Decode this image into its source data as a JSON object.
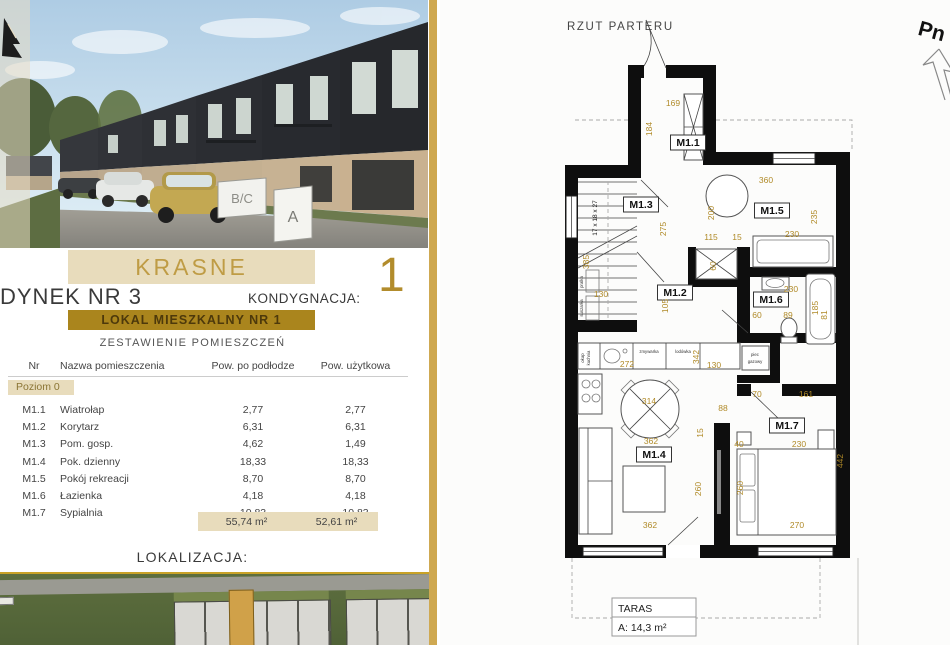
{
  "left": {
    "project_title": "KRASNE",
    "building_title": "DYNEK NR 3",
    "kondygnacja_label": "KONDYGNACJA:",
    "kondygnacja_value": "1",
    "lokal_band": "LOKAL MIESZKALNY NR 1",
    "table_title": "ZESTAWIENIE POMIESZCZEŃ",
    "lokalizacja_label": "LOKALIZACJA:",
    "table": {
      "headers": [
        "Nr",
        "Nazwa pomieszczenia",
        "Pow. po podłodze",
        "Pow. użytkowa"
      ],
      "level_label": "Poziom 0",
      "rows": [
        {
          "nr": "M1.1",
          "name": "Wiatrołap",
          "floor": "2,77",
          "usable": "2,77"
        },
        {
          "nr": "M1.2",
          "name": "Korytarz",
          "floor": "6,31",
          "usable": "6,31"
        },
        {
          "nr": "M1.3",
          "name": "Pom. gosp.",
          "floor": "4,62",
          "usable": "1,49"
        },
        {
          "nr": "M1.4",
          "name": "Pok. dzienny",
          "floor": "18,33",
          "usable": "18,33"
        },
        {
          "nr": "M1.5",
          "name": "Pokój rekreacji",
          "floor": "8,70",
          "usable": "8,70"
        },
        {
          "nr": "M1.6",
          "name": "Łazienka",
          "floor": "4,18",
          "usable": "4,18"
        },
        {
          "nr": "M1.7",
          "name": "Sypialnia",
          "floor": "10,83",
          "usable": "10,83"
        }
      ],
      "total_floor": "55,74 m²",
      "total_usable": "52,61 m²"
    }
  },
  "photo": {
    "signs": [
      "B/C",
      "A"
    ]
  },
  "plan": {
    "title": "RZUT PARTERU",
    "terrace": {
      "name": "TARAS",
      "area": "A: 14,3 m²"
    },
    "labels": [
      {
        "t": "M1.1",
        "x": 688,
        "y": 146,
        "cls": "room",
        "box": [
          35,
          15
        ]
      },
      {
        "t": "M1.2",
        "x": 675,
        "y": 296,
        "cls": "room",
        "box": [
          35,
          15
        ]
      },
      {
        "t": "M1.3",
        "x": 641,
        "y": 208,
        "cls": "room",
        "box": [
          35,
          15
        ]
      },
      {
        "t": "M1.4",
        "x": 654,
        "y": 458,
        "cls": "room",
        "box": [
          35,
          15
        ]
      },
      {
        "t": "M1.5",
        "x": 772,
        "y": 214,
        "cls": "room",
        "box": [
          35,
          15
        ]
      },
      {
        "t": "M1.6",
        "x": 771,
        "y": 303,
        "cls": "room",
        "box": [
          35,
          15
        ]
      },
      {
        "t": "M1.7",
        "x": 787,
        "y": 429,
        "cls": "room",
        "box": [
          35,
          15
        ]
      },
      {
        "t": "169",
        "x": 673,
        "y": 106
      },
      {
        "t": "360",
        "x": 766,
        "y": 183
      },
      {
        "t": "115",
        "x": 711,
        "y": 240
      },
      {
        "t": "15",
        "x": 737,
        "y": 240
      },
      {
        "t": "230",
        "x": 792,
        "y": 237
      },
      {
        "t": "130",
        "x": 601,
        "y": 297
      },
      {
        "t": "130",
        "x": 714,
        "y": 368
      },
      {
        "t": "272",
        "x": 627,
        "y": 367
      },
      {
        "t": "314",
        "x": 649,
        "y": 404
      },
      {
        "t": "88",
        "x": 723,
        "y": 411
      },
      {
        "t": "362",
        "x": 651,
        "y": 444
      },
      {
        "t": "70",
        "x": 757,
        "y": 397
      },
      {
        "t": "161",
        "x": 806,
        "y": 397
      },
      {
        "t": "40",
        "x": 739,
        "y": 447
      },
      {
        "t": "230",
        "x": 799,
        "y": 447
      },
      {
        "t": "362",
        "x": 650,
        "y": 528
      },
      {
        "t": "270",
        "x": 797,
        "y": 528
      },
      {
        "t": "230",
        "x": 791,
        "y": 292
      },
      {
        "t": "60",
        "x": 757,
        "y": 318
      },
      {
        "t": "89",
        "x": 788,
        "y": 318
      },
      {
        "t": "184",
        "x": 652,
        "y": 129,
        "rot": -90
      },
      {
        "t": "200",
        "x": 714,
        "y": 213,
        "rot": -90
      },
      {
        "t": "275",
        "x": 666,
        "y": 229,
        "rot": -90
      },
      {
        "t": "235",
        "x": 817,
        "y": 217,
        "rot": -90
      },
      {
        "t": "60",
        "x": 716,
        "y": 266,
        "rot": -90
      },
      {
        "t": "385",
        "x": 589,
        "y": 262,
        "rot": -90
      },
      {
        "t": "105",
        "x": 668,
        "y": 306,
        "rot": -90
      },
      {
        "t": "342",
        "x": 699,
        "y": 357,
        "rot": -90
      },
      {
        "t": "15",
        "x": 703,
        "y": 433,
        "rot": -90
      },
      {
        "t": "260",
        "x": 701,
        "y": 489,
        "rot": -90
      },
      {
        "t": "442",
        "x": 843,
        "y": 461,
        "rot": -90
      },
      {
        "t": "260",
        "x": 743,
        "y": 488,
        "rot": -90
      },
      {
        "t": "185",
        "x": 818,
        "y": 308,
        "rot": -90
      },
      {
        "t": "81",
        "x": 827,
        "y": 315,
        "rot": -90
      },
      {
        "t": "zmywarka",
        "x": 649,
        "y": 353,
        "cls": "tiny"
      },
      {
        "t": "lodówka",
        "x": 683,
        "y": 353,
        "cls": "tiny"
      },
      {
        "t": "okap",
        "x": 584,
        "y": 358,
        "rot": -90,
        "cls": "tiny"
      },
      {
        "t": "kuchnia",
        "x": 590,
        "y": 358,
        "rot": -90,
        "cls": "tiny"
      },
      {
        "t": "pralka",
        "x": 583,
        "y": 282,
        "rot": -90,
        "cls": "tiny"
      },
      {
        "t": "suszarka",
        "x": 583,
        "y": 308,
        "rot": -90,
        "cls": "tiny"
      },
      {
        "t": "piec",
        "x": 755,
        "y": 356,
        "cls": "tiny"
      },
      {
        "t": "gazowy",
        "x": 755,
        "y": 363,
        "cls": "tiny"
      },
      {
        "t": "17 x 18 x 27",
        "x": 597,
        "y": 218,
        "rot": -90,
        "cls": "stairs"
      },
      {
        "t": "Pn",
        "x": 930,
        "y": 38,
        "rot": 15,
        "cls": "north"
      }
    ]
  }
}
